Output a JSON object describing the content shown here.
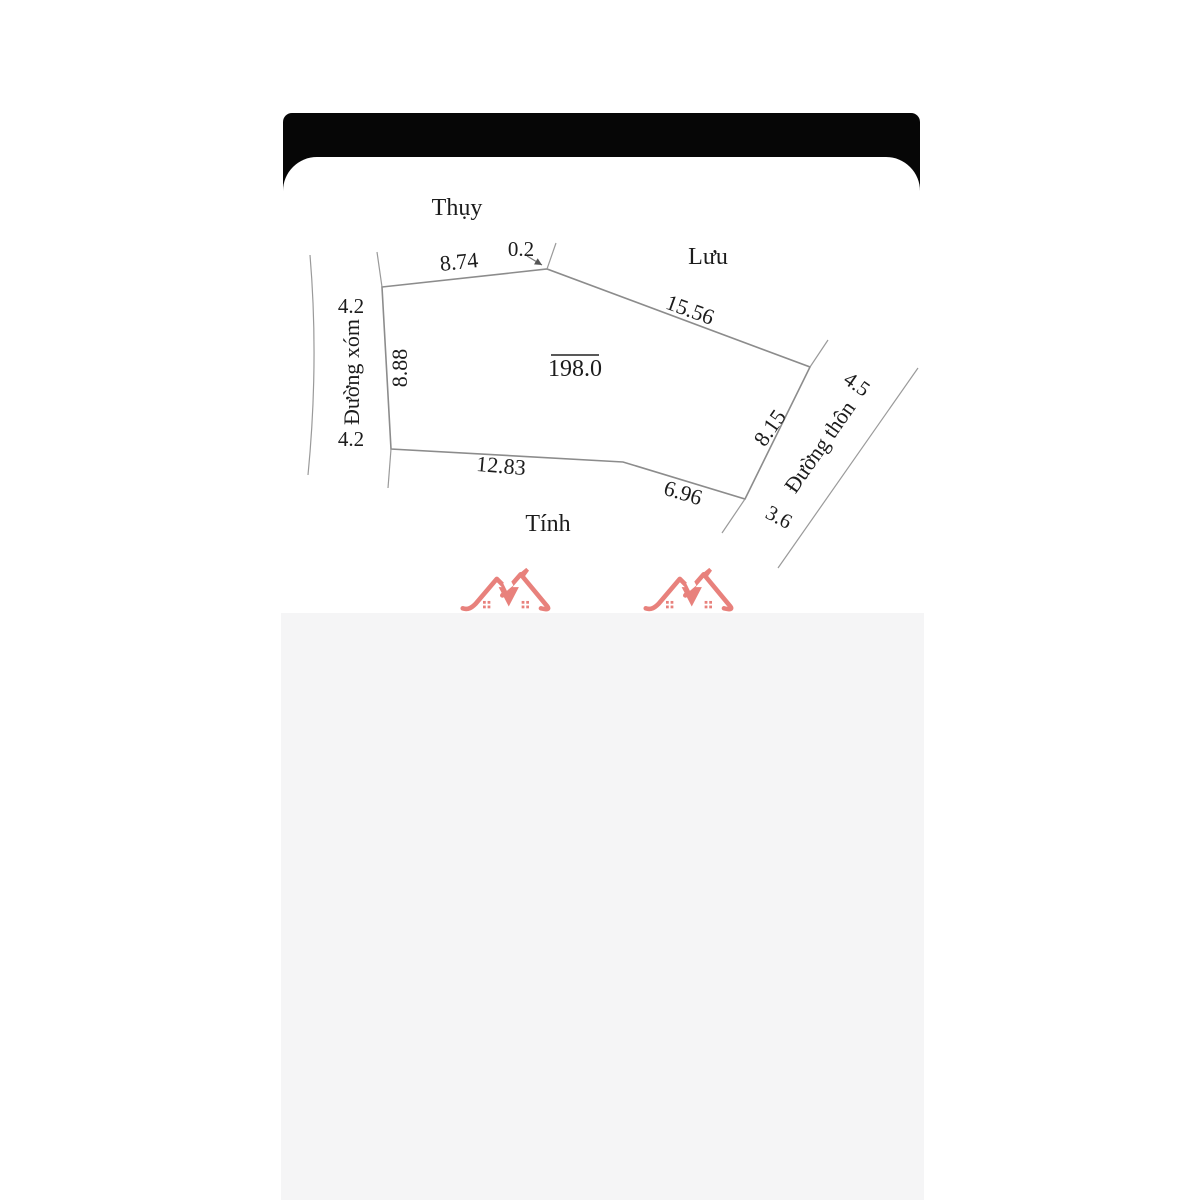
{
  "diagram": {
    "area_label": "198.0",
    "neighbors": {
      "top": "Thụy",
      "right": "Lưu",
      "bottom": "Tính"
    },
    "roads": {
      "left": {
        "name": "Đường xóm",
        "width_top": "4.2",
        "width_bottom": "4.2"
      },
      "right": {
        "name": "Đường thôn",
        "width_top": "4.5",
        "width_bottom": "3.6"
      }
    },
    "dimensions": {
      "top_edge": "8.74",
      "top_notch": "0.2",
      "upper_right_edge": "15.56",
      "right_edge": "8.15",
      "lower_right_edge": "6.96",
      "bottom_edge": "12.83",
      "left_edge": "8.88"
    },
    "colors": {
      "top_bar": "#060606",
      "panel": "#ffffff",
      "bottom_area": "#f5f5f6",
      "line": "#8c8c8c",
      "text": "#1c1c1c",
      "watermark": "#e8817c"
    }
  },
  "watermark": {
    "icon": "double-roof-house-icon",
    "count": 2
  }
}
